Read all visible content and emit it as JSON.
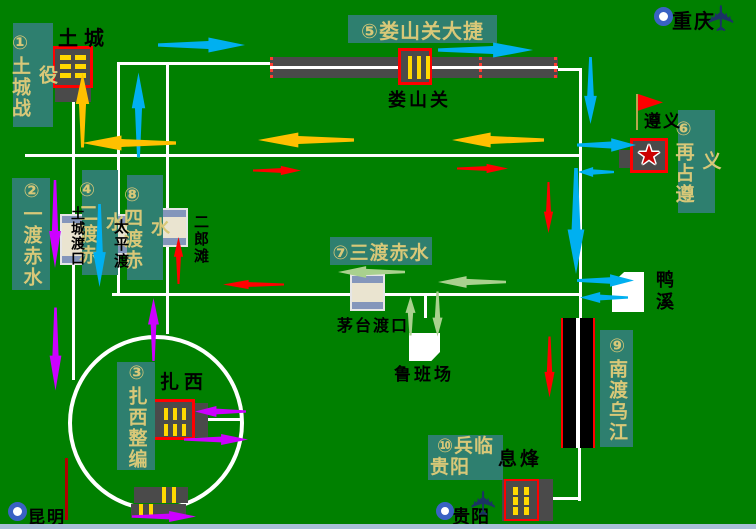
{
  "colors": {
    "bg": "#008000",
    "labelBg": "#2e7f6f",
    "labelText": "#d8c878",
    "road": "#ffffff",
    "cyan": "#00b0f0",
    "orange": "#ffc000",
    "red": "#ff0000",
    "magenta": "#cc00ff",
    "green": "#a9d18e",
    "dark": "#4a4a4a",
    "yellow": "#ffd800",
    "redBorder": "#ff0000",
    "ferryBody": "#eae4d0",
    "ferryCap": "#8496bb",
    "ring": "#3a62c4",
    "navy": "#1b3364",
    "starRed": "#cc0000",
    "strip": "#a8bfd8",
    "darkRed": "#b00000",
    "pole": "#b8a64e"
  },
  "icons": {
    "airplane": "✈",
    "star": "★"
  },
  "campaign_labels": {
    "battle_tucheng": "①土城战役",
    "first_crossing": "②一渡赤水",
    "zhaxi_reorg": "③扎西整编",
    "second_crossing": "④二渡赤水",
    "loushanguan_victory": "⑤娄山关大捷",
    "retake_zunyi": "⑥再占遵义",
    "third_crossing": "⑦三渡赤水",
    "fourth_crossing": "⑧四渡赤水",
    "south_cross_wujiang": "⑨南渡乌江",
    "approach_guiyang_line1": "⑩兵临",
    "approach_guiyang_line2": "贵阳"
  },
  "places": {
    "tucheng": "土城",
    "loushanguan": "娄山关",
    "zunyi": "遵义",
    "chongqing": "重庆",
    "yaxi": "鸭溪",
    "erlangtan": "二郎滩",
    "taipingdu": "太平渡",
    "tucheng_ferry": "土城渡口",
    "maotai_ferry": "茅台渡口",
    "lubanchang": "鲁班场",
    "zhaxi": "扎西",
    "xifeng": "息烽",
    "guiyang": "贵阳",
    "kunming": "昆明"
  }
}
